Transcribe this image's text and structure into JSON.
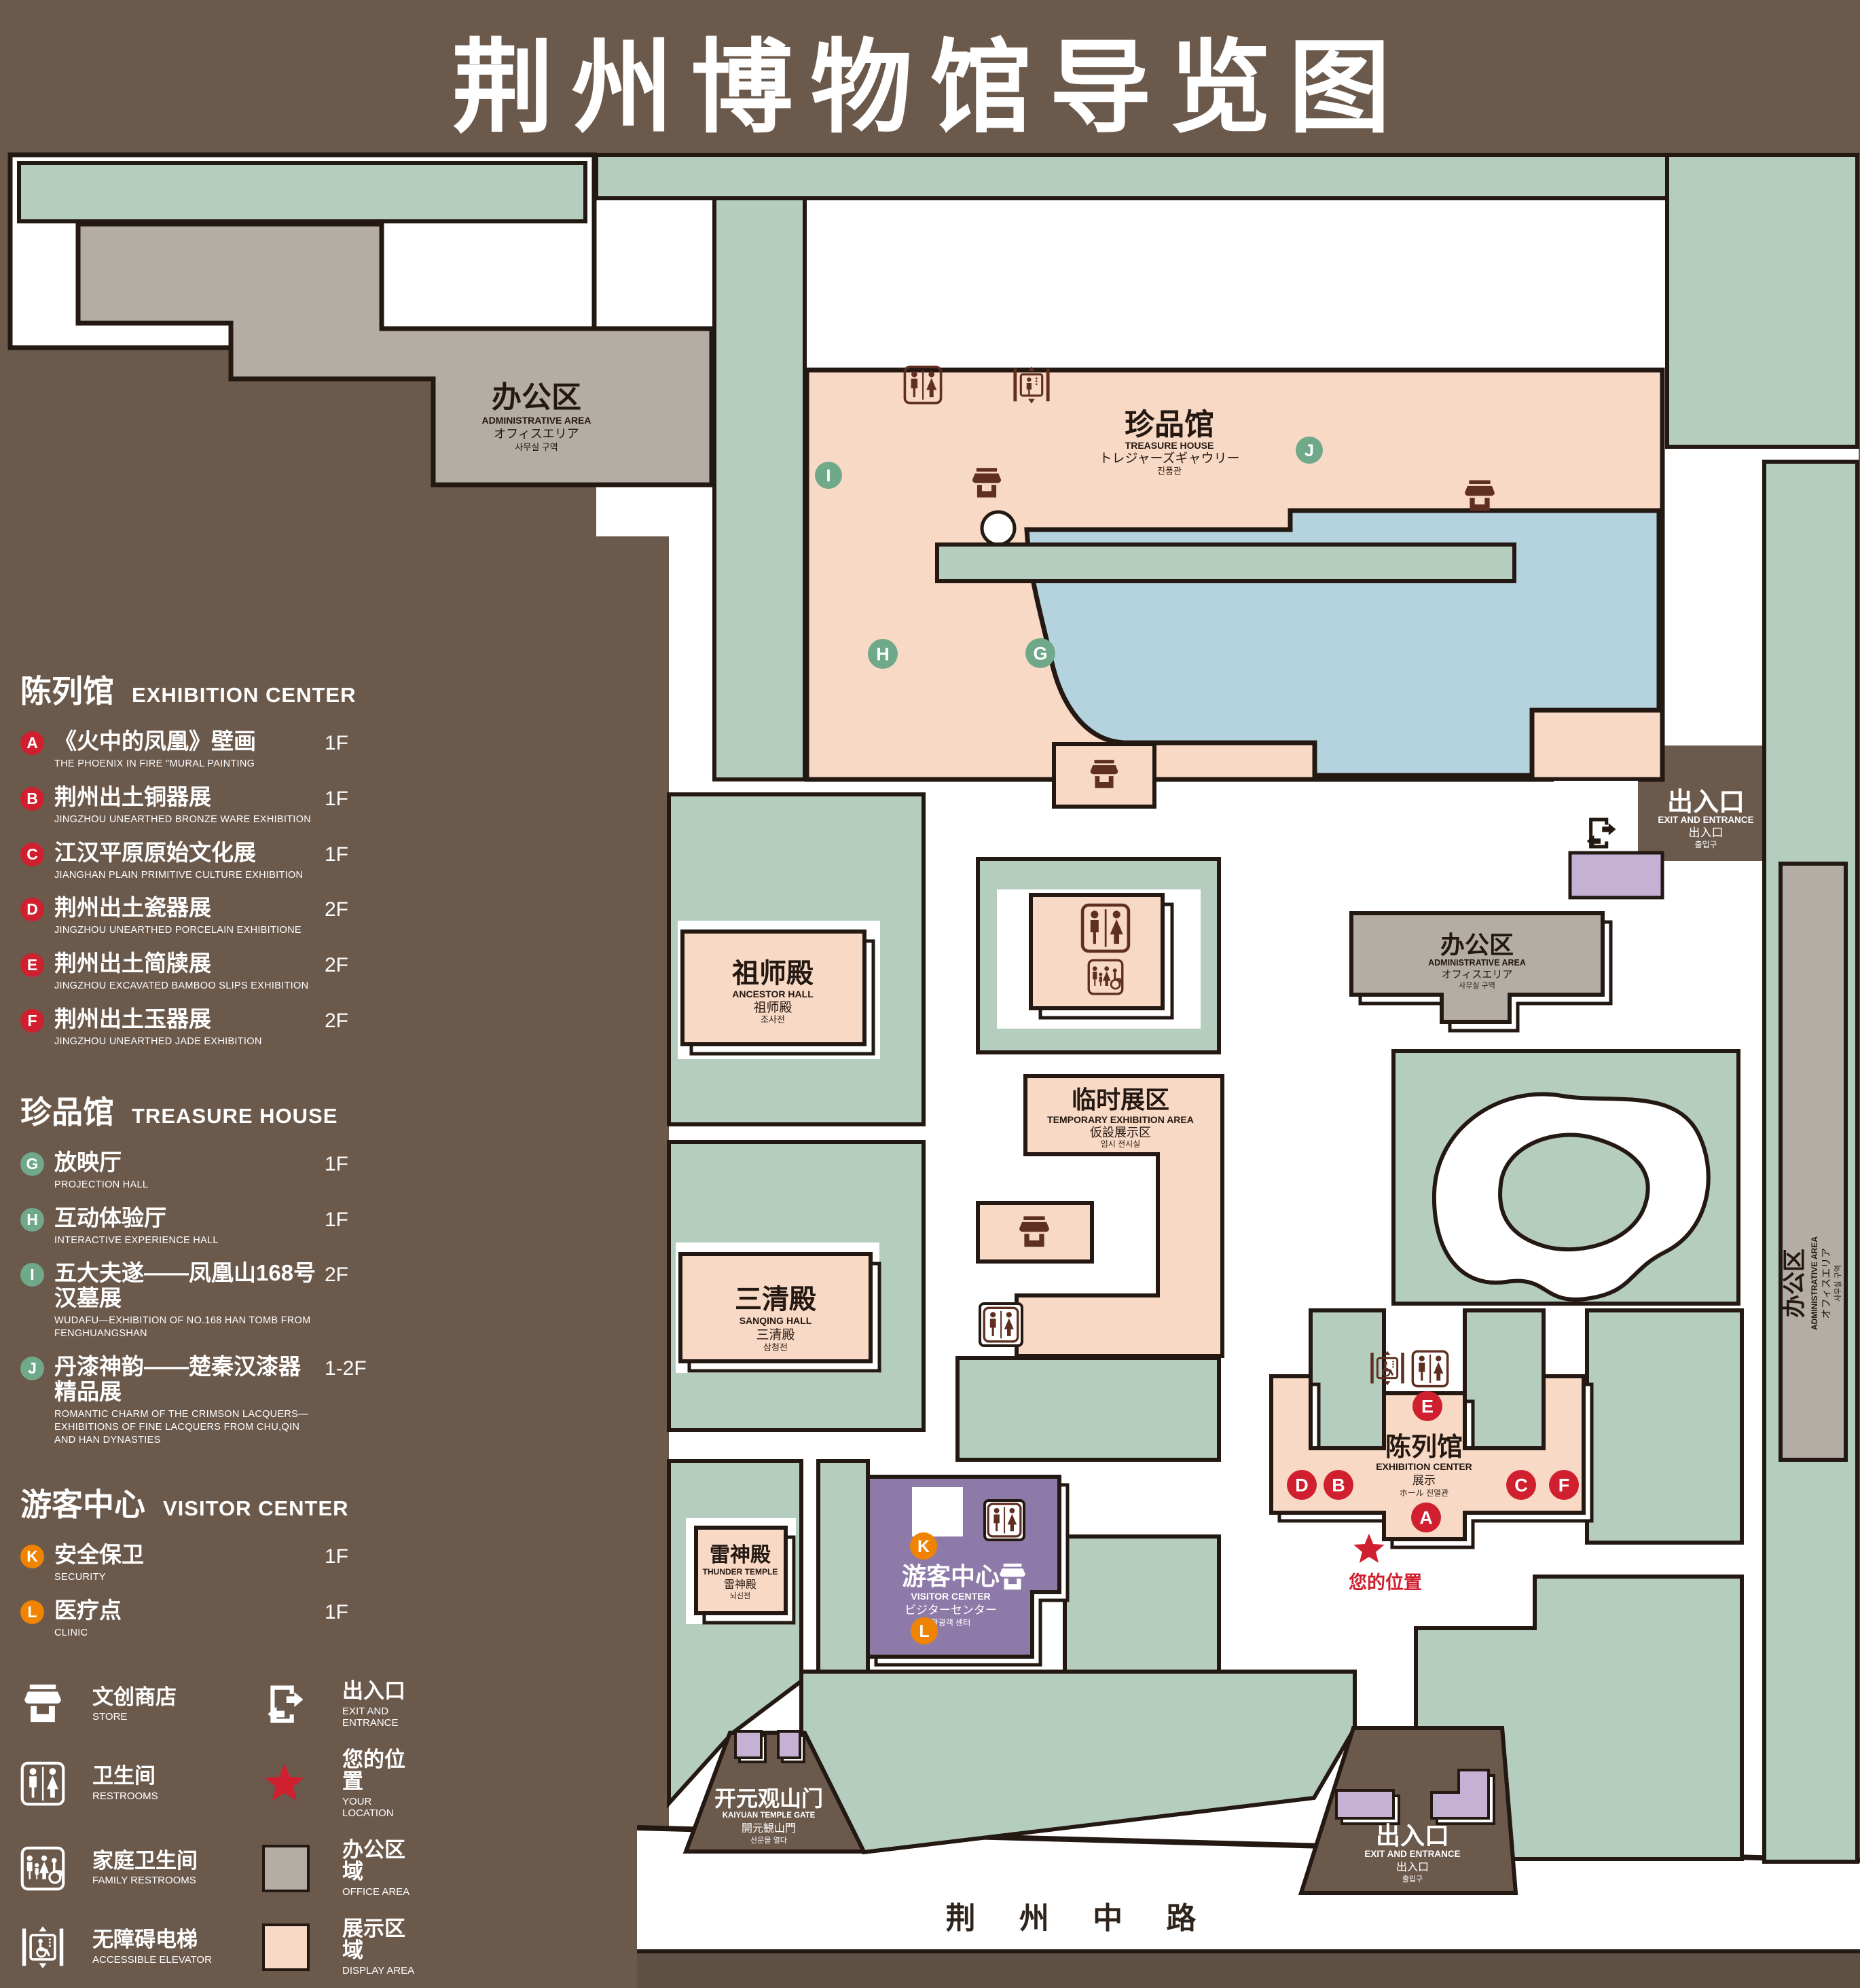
{
  "title": {
    "zh": "荆州博物馆导览图",
    "en": "GUIDE MAP OF JINGZHOU MUSEUM"
  },
  "colors": {
    "background": "#6b594c",
    "outline": "#241812",
    "green_area": "#b5cdbf",
    "display_area": "#f8d9c5",
    "office_area": "#b3ada5",
    "pond": "#b5d3de",
    "visitor_center": "#8d7aa9",
    "small_building": "#c4b1d3",
    "icon_brown": "#5f2f21",
    "marker_red": "#d01f2f",
    "marker_green": "#6fa98a",
    "marker_orange": "#f08300"
  },
  "legend": {
    "sections": [
      {
        "zh": "陈列馆",
        "en": "EXHIBITION CENTER",
        "items": [
          {
            "key": "A",
            "zh": "《火中的凤凰》壁画",
            "en": "THE PHOENIX IN FIRE \"MURAL PAINTING",
            "floor": "1F"
          },
          {
            "key": "B",
            "zh": "荆州出土铜器展",
            "en": "JINGZHOU UNEARTHED BRONZE WARE EXHIBITION",
            "floor": "1F"
          },
          {
            "key": "C",
            "zh": "江汉平原原始文化展",
            "en": "JIANGHAN PLAIN PRIMITIVE CULTURE EXHIBITION",
            "floor": "1F"
          },
          {
            "key": "D",
            "zh": "荆州出土瓷器展",
            "en": "JINGZHOU UNEARTHED PORCELAIN EXHIBITIONE",
            "floor": "2F"
          },
          {
            "key": "E",
            "zh": "荆州出土简牍展",
            "en": "JINGZHOU EXCAVATED BAMBOO SLIPS EXHIBITION",
            "floor": "2F"
          },
          {
            "key": "F",
            "zh": "荆州出土玉器展",
            "en": "JINGZHOU UNEARTHED JADE EXHIBITION",
            "floor": "2F"
          }
        ]
      },
      {
        "zh": "珍品馆",
        "en": "TREASURE HOUSE",
        "items": [
          {
            "key": "G",
            "zh": "放映厅",
            "en": "PROJECTION HALL",
            "floor": "1F"
          },
          {
            "key": "H",
            "zh": "互动体验厅",
            "en": "INTERACTIVE EXPERIENCE HALL",
            "floor": "1F"
          },
          {
            "key": "I",
            "zh": "五大夫遂——凤凰山168号汉墓展",
            "en": "WUDAFU—EXHIBITION OF NO.168 HAN TOMB FROM FENGHUANGSHAN",
            "floor": "2F"
          },
          {
            "key": "J",
            "zh": "丹漆神韵——楚秦汉漆器精品展",
            "en": "ROMANTIC CHARM OF THE CRIMSON LACQUERS—EXHIBITIONS OF FINE LACQUERS FROM CHU,QIN AND HAN DYNASTIES",
            "floor": "1-2F"
          }
        ]
      },
      {
        "zh": "游客中心",
        "en": "VISITOR CENTER",
        "items": [
          {
            "key": "K",
            "zh": "安全保卫",
            "en": "SECURITY",
            "floor": "1F"
          },
          {
            "key": "L",
            "zh": "医疗点",
            "en": "CLINIC",
            "floor": "1F"
          }
        ]
      }
    ],
    "symbols": {
      "left": [
        {
          "icon": "store-icon",
          "zh": "文创商店",
          "en": "STORE"
        },
        {
          "icon": "restrooms-icon",
          "zh": "卫生间",
          "en": "RESTROOMS"
        },
        {
          "icon": "family-restrooms-icon",
          "zh": "家庭卫生间",
          "en": "FAMILY RESTROOMS"
        },
        {
          "icon": "accessible-elevator-icon",
          "zh": "无障碍电梯",
          "en": "ACCESSIBLE  ELEVATOR"
        },
        {
          "icon": "elevator-icon",
          "zh": "电梯",
          "en": "Elevator"
        }
      ],
      "right": [
        {
          "icon": "exit-entrance-icon",
          "zh": "出入口",
          "en": "EXIT AND ENTRANCE"
        },
        {
          "icon": "your-location-icon",
          "zh": "您的位置",
          "en": "YOUR LOCATION"
        },
        {
          "icon": "office-area-swatch",
          "zh": "办公区域",
          "en": "OFFICE AREA"
        },
        {
          "icon": "display-area-swatch",
          "zh": "展示区域",
          "en": "DISPLAY AREA"
        }
      ]
    }
  },
  "map": {
    "markers": [
      "A",
      "B",
      "C",
      "D",
      "E",
      "F",
      "G",
      "H",
      "I",
      "J",
      "K",
      "L"
    ],
    "labels": {
      "admin_top_left": {
        "zh": "办公区",
        "en": "ADMINISTRATIVE AREA",
        "ja": "オフィスエリア",
        "ko": "사무실 구역"
      },
      "treasure_house": {
        "zh": "珍品馆",
        "en": "TREASURE HOUSE",
        "ja": "トレジャーズギャウリー",
        "ko": "진품관"
      },
      "ancestor_hall": {
        "zh": "祖师殿",
        "en": "ANCESTOR HALL",
        "ja": "祖师殿",
        "ko": "조사전"
      },
      "temporary_area": {
        "zh": "临时展区",
        "en": "TEMPORARY EXHIBITION AREA",
        "ja": "仮設展示区",
        "ko": "임시 전시실"
      },
      "sanqing_hall": {
        "zh": "三清殿",
        "en": "SANQING HALL",
        "ja": "三清殿",
        "ko": "삼청전"
      },
      "thunder_temple": {
        "zh": "雷神殿",
        "en": "THUNDER TEMPLE",
        "ja": "雷神殿",
        "ko": "뇌신전"
      },
      "visitor_center": {
        "zh": "游客中心",
        "en": "VISITOR CENTER",
        "ja": "ビジターセンター",
        "ko": "관광객 센터"
      },
      "exhibition_center": {
        "zh": "陈列馆",
        "en": "EXHIBITION CENTER",
        "ja": "展示",
        "ko": "ホール 진열관"
      },
      "admin_right": {
        "zh": "办公区",
        "en": "ADMINISTRATIVE AREA",
        "ja": "オフィスエリア",
        "ko": "사무실 구역"
      },
      "admin_strip": {
        "zh": "办公区",
        "en": "ADMINISTRATIVE AREA",
        "ja": "オフィスエリア",
        "ko": "사무실 구역"
      },
      "exit_top_right": {
        "zh": "出入口",
        "en": "EXIT AND ENTRANCE",
        "zh2": "出入口",
        "ko": "출입구"
      },
      "exit_bottom": {
        "zh": "出入口",
        "en": "EXIT AND ENTRANCE",
        "zh2": "出入口",
        "ko": "출입구"
      },
      "kaiyuan_gate": {
        "zh": "开元观山门",
        "en": "KAIYUAN TEMPLE GATE",
        "ja": "開元観山門",
        "ko": "산문을 열다"
      },
      "your_location": {
        "zh": "您的位置"
      },
      "road": "荆 州 中 路"
    }
  }
}
